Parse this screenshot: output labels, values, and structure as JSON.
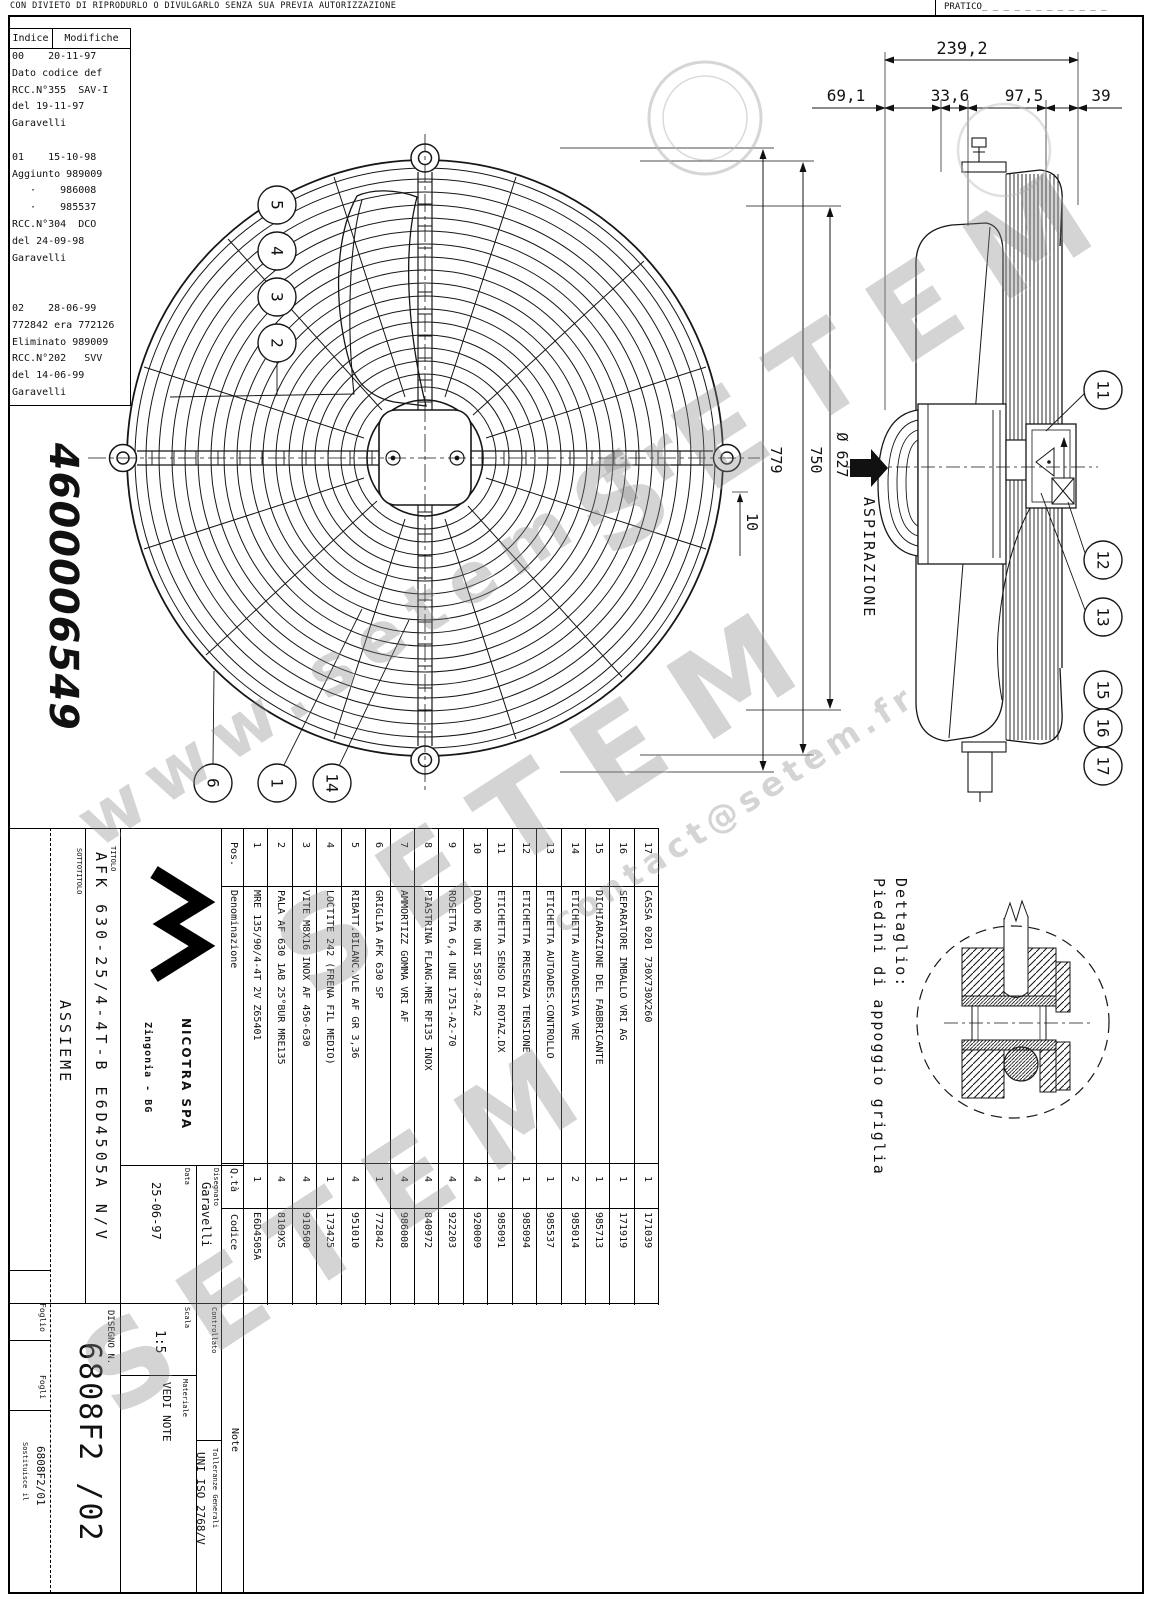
{
  "sheet": {
    "top_notice": "CON DIVIETO DI RIPRODURLO O DIVULGARLO SENZA SUA PREVIA AUTORIZZAZIONE",
    "pratico_label": "PRATICO_ _ _ _ _ _ _ _ _ _ _ _",
    "big_number": "4600006549"
  },
  "revision_table": {
    "col_index": "Indice",
    "col_changes": "Modifiche",
    "lines": [
      "00    20-11-97",
      "Dato codice def",
      "RCC.N°355  SAV-I",
      "del 19-11-97",
      "Garavelli",
      "",
      "01    15-10-98",
      "Aggiunto 989009",
      "   ·    986008",
      "   ·    985537",
      "RCC.N°304  DCO",
      "del 24-09-98",
      "Garavelli",
      "",
      "",
      "02    28-06-99",
      "772842 era 772126",
      "Eliminato 989009",
      "RCC.N°202   SVV",
      "del 14-06-99",
      "Garavelli"
    ]
  },
  "dimensions": {
    "overall_depth": "239,2",
    "seg1": "69,1",
    "seg2": "33,6",
    "seg3": "97,5",
    "seg4": "39",
    "overall_height": "779",
    "guard_diameter": "750",
    "impeller_diameter": "Ø 627",
    "grille_gap": "10",
    "airflow": "ASPIRAZIONE"
  },
  "balloons": {
    "front": [
      "5",
      "4",
      "3",
      "2",
      "6",
      "1",
      "14"
    ],
    "side": [
      "11",
      "12",
      "13",
      "15",
      "16",
      "17"
    ]
  },
  "detail": {
    "title": "Dettaglio:",
    "subtitle": "Piedini di appoggio griglia"
  },
  "parts_table": {
    "headers": {
      "pos": "Pos.",
      "name": "Denominazione",
      "qty": "Q.tà",
      "code": "Codice"
    },
    "items": [
      {
        "pos": "1",
        "name": "MRE 135/90/4-4T 2V Z65401",
        "qty": "1",
        "code": "E6D4505A"
      },
      {
        "pos": "2",
        "name": "PALA AF 630 1AB 25°BUR MRE135",
        "qty": "4",
        "code": "8109X5"
      },
      {
        "pos": "3",
        "name": "VITE M8X16 INOX AF 450-630",
        "qty": "4",
        "code": "910500"
      },
      {
        "pos": "4",
        "name": "LOCTITE 242 (FRENA FIL MEDIO)",
        "qty": "1",
        "code": "173425"
      },
      {
        "pos": "5",
        "name": "RIBATT.BILANC.VLE AF GR 3,36",
        "qty": "4",
        "code": "951010"
      },
      {
        "pos": "6",
        "name": "GRIGLIA AFK 630 SP",
        "qty": "1",
        "code": "772842"
      },
      {
        "pos": "7",
        "name": "AMMORTIZZ GOMMA VRI AF",
        "qty": "4",
        "code": "986008"
      },
      {
        "pos": "8",
        "name": "PIASTRINA FLANG.MRE RF135 INOX",
        "qty": "4",
        "code": "840972"
      },
      {
        "pos": "9",
        "name": "ROSETTA 6,4 UNI 1751-A2-70",
        "qty": "4",
        "code": "922203"
      },
      {
        "pos": "10",
        "name": "DADO M6 UNI 5587-8-A2",
        "qty": "4",
        "code": "920009"
      },
      {
        "pos": "11",
        "name": "ETICHETTA SENSO DI ROTAZ.DX",
        "qty": "1",
        "code": "985091"
      },
      {
        "pos": "12",
        "name": "ETICHETTA PRESENZA TENSIONE",
        "qty": "1",
        "code": "985094"
      },
      {
        "pos": "13",
        "name": "ETICHETTA AUTOADES.CONTROLLO",
        "qty": "1",
        "code": "985537"
      },
      {
        "pos": "14",
        "name": "ETICHETTA AUTOADESIVA VRE",
        "qty": "2",
        "code": "985014"
      },
      {
        "pos": "15",
        "name": "DICHIARAZIONE DEL FABBRICANTE",
        "qty": "1",
        "code": "985713"
      },
      {
        "pos": "16",
        "name": "SEPARATORE IMBALLO VRI AG",
        "qty": "1",
        "code": "171919"
      },
      {
        "pos": "17",
        "name": "CASSA 0201 730X730X260",
        "qty": "1",
        "code": "171039"
      }
    ]
  },
  "title_block": {
    "titolo_label": "TITOLO",
    "titolo": "AFK 630-25/4-4T-B E6D4505A N/V",
    "sottotitolo_label": "SOTTOTITOLO",
    "sottotitolo": "ASSIEME",
    "company": "NICOTRA SPA",
    "company_city": "Zingonia - BG",
    "disegnato_label": "Disegnato",
    "disegnato": "Garavelli",
    "data_label": "Data",
    "data": "25-06-97",
    "controllato_label": "Controllato",
    "scala_label": "Scala",
    "scala": "1:5",
    "materiale_label": "Materiale",
    "materiale": "VEDI NOTE",
    "disegno_label": "DISEGNO N.",
    "disegno": "6808F2 /02",
    "tolleranze_label": "Tolleranze Generali",
    "tolleranze": "UNI ISO 2768/V",
    "note_label": "Note",
    "foglio_label": "Foglio",
    "fogli_label": "Fogli",
    "sostituisce_label": "Sostituisce il",
    "sostituisce": "6808F2/01"
  },
  "watermark": {
    "brand": "SETEM",
    "url": "www.setem.fr",
    "email": "contact@setem.fr"
  }
}
